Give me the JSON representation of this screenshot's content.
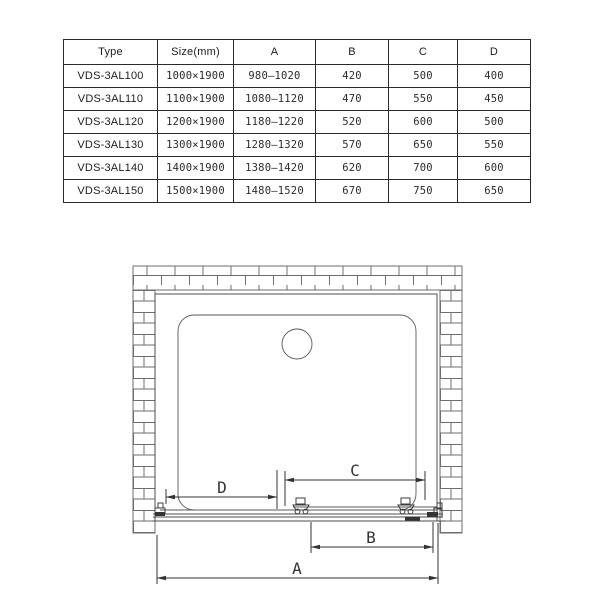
{
  "table": {
    "headers": [
      "Type",
      "Size(mm)",
      "A",
      "B",
      "C",
      "D"
    ],
    "rows": [
      [
        "VDS-3AL100",
        "1000×1900",
        "980–1020",
        "420",
        "500",
        "400"
      ],
      [
        "VDS-3AL110",
        "1100×1900",
        "1080–1120",
        "470",
        "550",
        "450"
      ],
      [
        "VDS-3AL120",
        "1200×1900",
        "1180–1220",
        "520",
        "600",
        "500"
      ],
      [
        "VDS-3AL130",
        "1300×1900",
        "1280–1320",
        "570",
        "650",
        "550"
      ],
      [
        "VDS-3AL140",
        "1400×1900",
        "1380–1420",
        "620",
        "700",
        "600"
      ],
      [
        "VDS-3AL150",
        "1500×1900",
        "1480–1520",
        "670",
        "750",
        "650"
      ]
    ]
  },
  "diagram": {
    "labels": {
      "a": "A",
      "b": "B",
      "c": "C",
      "d": "D"
    },
    "colors": {
      "line": "#4d4d4d",
      "brick": "#6e6e6e",
      "dimension": "#333333",
      "background": "#ffffff"
    }
  }
}
